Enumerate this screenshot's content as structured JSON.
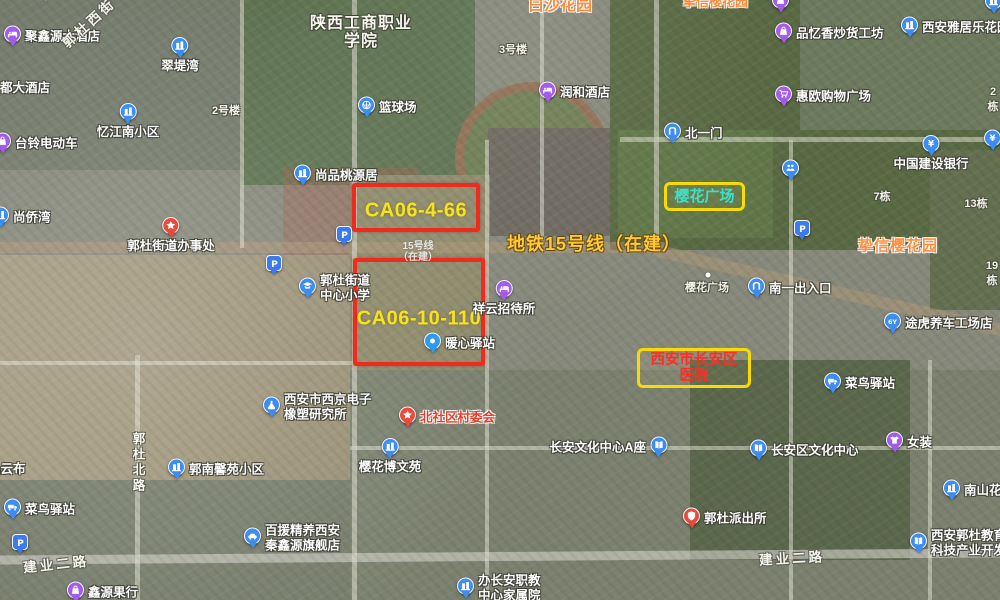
{
  "map_view": {
    "type": "satellite-map-screenshot",
    "colors": {
      "parcel_box_red": "#ee2b1e",
      "parcel_label_yellow": "#f2e41e",
      "highlight_box_yellow": "#f7da06",
      "sakura_square_cyan": "#3fe0ca",
      "hospital_red": "#ff2d23",
      "metro_yellow": "#ffc937",
      "estate_orange": "#ff8e3e",
      "poi_purple": "#a55ce8",
      "poi_blue": "#3e8df2",
      "poi_red": "#e94a3c"
    },
    "parcels": [
      {
        "name": "parcel-ca06-4-66",
        "label": "CA06-4-66",
        "x": 352,
        "y": 183,
        "w": 128,
        "h": 49,
        "ty": 24
      },
      {
        "name": "parcel-ca06-10-110",
        "label": "CA06-10-110",
        "x": 353,
        "y": 258,
        "w": 132,
        "h": 108,
        "ty": 57
      }
    ],
    "highlights": [
      {
        "name": "sakura-square-highlight",
        "lines": [
          "樱花广场"
        ],
        "x": 664,
        "y": 182,
        "w": 81,
        "h": 29,
        "color": "#3fe0ca",
        "fs": 15
      },
      {
        "name": "changan-hospital-highlight",
        "lines": [
          "西安市长安区",
          "医院"
        ],
        "x": 637,
        "y": 348,
        "w": 114,
        "h": 40,
        "color": "#ff2d23",
        "fs": 14.5
      }
    ],
    "overlay_labels": {
      "metro_line": {
        "text": "地铁15号线（在建）",
        "x": 507,
        "y": 243
      },
      "estate": {
        "text": "挚信樱花园",
        "x": 858,
        "y": 245
      },
      "top_edge_clipped": [
        {
          "text": "白沙花园",
          "x": 528,
          "size": 16
        },
        {
          "text": "挚信樱花园",
          "x": 683,
          "size": 13
        }
      ]
    },
    "road_labels": [
      {
        "text": "建业二路",
        "x": 56,
        "y": 563,
        "rot": -6
      },
      {
        "text": "建业二路",
        "x": 792,
        "y": 557,
        "rot": -3
      },
      {
        "text": "郭杜北路",
        "x": 138,
        "y": 463,
        "vertical": true
      },
      {
        "text": "郭杜西街",
        "x": 88,
        "y": 22,
        "rot": -42
      }
    ],
    "area_labels": [
      {
        "name": "college-label",
        "lines": [
          "陕西工商职业",
          "学院"
        ],
        "x": 361,
        "y": 33,
        "cls": "college"
      },
      {
        "name": "building-no-2haolou",
        "lines": [
          "2号楼"
        ],
        "x": 226,
        "y": 110,
        "cls": "bnum"
      },
      {
        "name": "building-no-3haolou",
        "lines": [
          "3号楼"
        ],
        "x": 513,
        "y": 49,
        "cls": "bnum"
      },
      {
        "name": "building-no-2dong",
        "lines": [
          "2栋"
        ],
        "x": 993,
        "y": 100,
        "cls": "bnum"
      },
      {
        "name": "building-no-7dong",
        "lines": [
          "7栋"
        ],
        "x": 882,
        "y": 196,
        "cls": "bnum"
      },
      {
        "name": "building-no-13dong",
        "lines": [
          "13栋"
        ],
        "x": 976,
        "y": 203,
        "cls": "bnum"
      },
      {
        "name": "building-no-19dong",
        "lines": [
          "19栋"
        ],
        "x": 992,
        "y": 274,
        "cls": "bnum"
      },
      {
        "name": "sakura-square-small-label",
        "lines": [
          "樱花广场"
        ],
        "x": 707,
        "y": 287,
        "cls": "bnum"
      },
      {
        "name": "metro-station-faint-label",
        "lines": [
          "15号线",
          "（在建）"
        ],
        "x": 418,
        "y": 252,
        "cls": "faint"
      }
    ],
    "dot_markers": [
      {
        "name": "sakura-square-dot",
        "x": 708,
        "y": 275
      }
    ],
    "pois": [
      {
        "name": "juxinyuan-hotel",
        "icon": "bed",
        "c": "purple",
        "x": 13,
        "y": 36,
        "label": "聚鑫源大酒店",
        "side": "r"
      },
      {
        "name": "duda-hotel",
        "icon": "none",
        "x": 0,
        "y": 88,
        "label": "都大酒店",
        "side": "r"
      },
      {
        "name": "cuidiwan-community",
        "icon": "building",
        "c": "blue",
        "x": 180,
        "y": 46,
        "label": "翠堤湾",
        "side": "b"
      },
      {
        "name": "yijiangnan-community",
        "icon": "building",
        "c": "blue",
        "x": 128,
        "y": 112,
        "label": "忆江南小区",
        "side": "b"
      },
      {
        "name": "tailing-ebike-shop",
        "icon": "bag",
        "c": "purple",
        "x": 3,
        "y": 143,
        "label": "台铃电动车",
        "side": "r"
      },
      {
        "name": "shangqiaowan",
        "icon": "building",
        "c": "blue",
        "x": 1,
        "y": 217,
        "label": "尚侨湾",
        "side": "r"
      },
      {
        "name": "shangpin-taoyuanju",
        "icon": "building",
        "c": "blue",
        "x": 303,
        "y": 175,
        "label": "尚品桃源居",
        "side": "r"
      },
      {
        "name": "guodu-subdistrict-office",
        "icon": "star",
        "c": "red",
        "x": 171,
        "y": 226,
        "label": "郭杜街道办事处",
        "side": "b"
      },
      {
        "name": "parking-school",
        "icon": "parking",
        "c": "pblue",
        "x": 345,
        "y": 236
      },
      {
        "name": "parking-west",
        "icon": "parking",
        "c": "pblue",
        "x": 275,
        "y": 265
      },
      {
        "name": "guodu-central-primary-school",
        "icon": "school",
        "c": "blue",
        "x": 308,
        "y": 288,
        "label": "郭杜街道",
        "label2": "中心小学",
        "side": "r2"
      },
      {
        "name": "basketball-court",
        "icon": "ball",
        "c": "blue",
        "x": 367,
        "y": 107,
        "label": "篮球场",
        "side": "r"
      },
      {
        "name": "runhe-hotel",
        "icon": "bed",
        "c": "purple",
        "x": 548,
        "y": 92,
        "label": "润和酒店",
        "side": "r"
      },
      {
        "name": "north-gate-one",
        "icon": "gate",
        "c": "blue",
        "x": 673,
        "y": 133,
        "label": "北一门",
        "side": "r"
      },
      {
        "name": "pinyixiang-snack-shop",
        "icon": "bag",
        "c": "purple",
        "x": 784,
        "y": 33,
        "label": "品忆香炒货工坊",
        "side": "r"
      },
      {
        "name": "yajule-garden",
        "icon": "building",
        "c": "blue",
        "x": 910,
        "y": 27,
        "label": "西安雅居乐花园",
        "side": "r"
      },
      {
        "name": "huiou-shopping-plaza",
        "icon": "cart",
        "c": "purple",
        "x": 784,
        "y": 96,
        "label": "惠欧购物广场",
        "side": "r"
      },
      {
        "name": "ccb-bank",
        "icon": "bank",
        "c": "blue",
        "x": 931,
        "y": 144,
        "label": "中国建设银行",
        "side": "b"
      },
      {
        "name": "atm-poi",
        "icon": "yuan",
        "c": "blue",
        "x": 993,
        "y": 140
      },
      {
        "name": "people-poi",
        "icon": "people",
        "c": "blue",
        "x": 791,
        "y": 170
      },
      {
        "name": "parking-sakura",
        "icon": "parking",
        "c": "pblue",
        "x": 803,
        "y": 230
      },
      {
        "name": "south-exit-one",
        "icon": "gate",
        "c": "blue",
        "x": 757,
        "y": 288,
        "label": "南一出入口",
        "side": "r"
      },
      {
        "name": "xiangyun-guesthouse",
        "icon": "bed",
        "c": "purple",
        "x": 504,
        "y": 289,
        "label": "祥云招待所",
        "side": "b"
      },
      {
        "name": "nuanxin-post",
        "icon": "dot",
        "c": "lblue",
        "x": 433,
        "y": 343,
        "label": "暖心驿站",
        "side": "r"
      },
      {
        "name": "tuhu-car-care",
        "icon": "tuhu",
        "c": "blue",
        "x": 893,
        "y": 323,
        "label": "途虎养车工场店",
        "side": "r"
      },
      {
        "name": "cainiao-station-east",
        "icon": "truck",
        "c": "blue",
        "x": 833,
        "y": 383,
        "label": "菜鸟驿站",
        "side": "r"
      },
      {
        "name": "womens-clothing-shop",
        "icon": "shirt",
        "c": "purple",
        "x": 895,
        "y": 442,
        "label": "女装",
        "side": "r"
      },
      {
        "name": "changan-cultural-center-a",
        "icon": "book",
        "c": "blue",
        "x": 658,
        "y": 447,
        "label": "长安文化中心A座",
        "side": "l"
      },
      {
        "name": "changan-district-cultural-center",
        "icon": "book",
        "c": "blue",
        "x": 759,
        "y": 450,
        "label": "长安区文化中心",
        "side": "r"
      },
      {
        "name": "nanshan-garden",
        "icon": "building",
        "c": "blue",
        "x": 952,
        "y": 490,
        "label": "南山花园",
        "side": "r"
      },
      {
        "name": "xijing-electronics-institute",
        "icon": "flask",
        "c": "blue",
        "x": 272,
        "y": 407,
        "label": "西安市西京电子",
        "label2": "橡塑研究所",
        "side": "r2"
      },
      {
        "name": "beishequ-village-committee",
        "icon": "star",
        "c": "red",
        "x": 408,
        "y": 417,
        "label": "北社区村委会",
        "side": "r",
        "lred": true
      },
      {
        "name": "yinghua-bowenyuan",
        "icon": "building",
        "c": "blue",
        "x": 390,
        "y": 447,
        "label": "樱花博文苑",
        "side": "b"
      },
      {
        "name": "guonan-xinyuan-community",
        "icon": "building",
        "c": "blue",
        "x": 177,
        "y": 469,
        "label": "郭南馨苑小区",
        "side": "r"
      },
      {
        "name": "pinyunbu-shop",
        "icon": "none",
        "x": -12,
        "y": 469,
        "label": "品云布",
        "side": "r"
      },
      {
        "name": "cainiao-station-west",
        "icon": "truck",
        "c": "blue",
        "x": 13,
        "y": 509,
        "label": "菜鸟驿站",
        "side": "r"
      },
      {
        "name": "parking-southwest",
        "icon": "parking",
        "c": "pblue",
        "x": 21,
        "y": 544
      },
      {
        "name": "xinyuan-fruit-shop",
        "icon": "bag",
        "c": "purple",
        "x": 76,
        "y": 592,
        "label": "鑫源果行",
        "side": "r"
      },
      {
        "name": "baiyuan-car-care",
        "icon": "car",
        "c": "blue",
        "x": 253,
        "y": 538,
        "label": "百援精养西安",
        "label2": "秦鑫源旗舰店",
        "side": "r2"
      },
      {
        "name": "guodu-police-station",
        "icon": "badge",
        "c": "red",
        "x": 692,
        "y": 518,
        "label": "郭杜派出所",
        "side": "r"
      },
      {
        "name": "changan-vocational-housing",
        "icon": "building",
        "c": "blue",
        "x": 466,
        "y": 588,
        "label": "办长安职教",
        "label2": "中心家属院",
        "side": "r2"
      },
      {
        "name": "guodu-education-tech-park",
        "icon": "book",
        "c": "blue",
        "x": 919,
        "y": 543,
        "label": "西安郭杜教育",
        "label2": "科技产业开发",
        "side": "r2"
      },
      {
        "name": "clipped-poi-top",
        "icon": "bag",
        "c": "purple",
        "x": 781,
        "y": 2
      },
      {
        "name": "clipped-poi-top-right",
        "icon": "building",
        "c": "blue",
        "x": 994,
        "y": 3
      }
    ]
  }
}
